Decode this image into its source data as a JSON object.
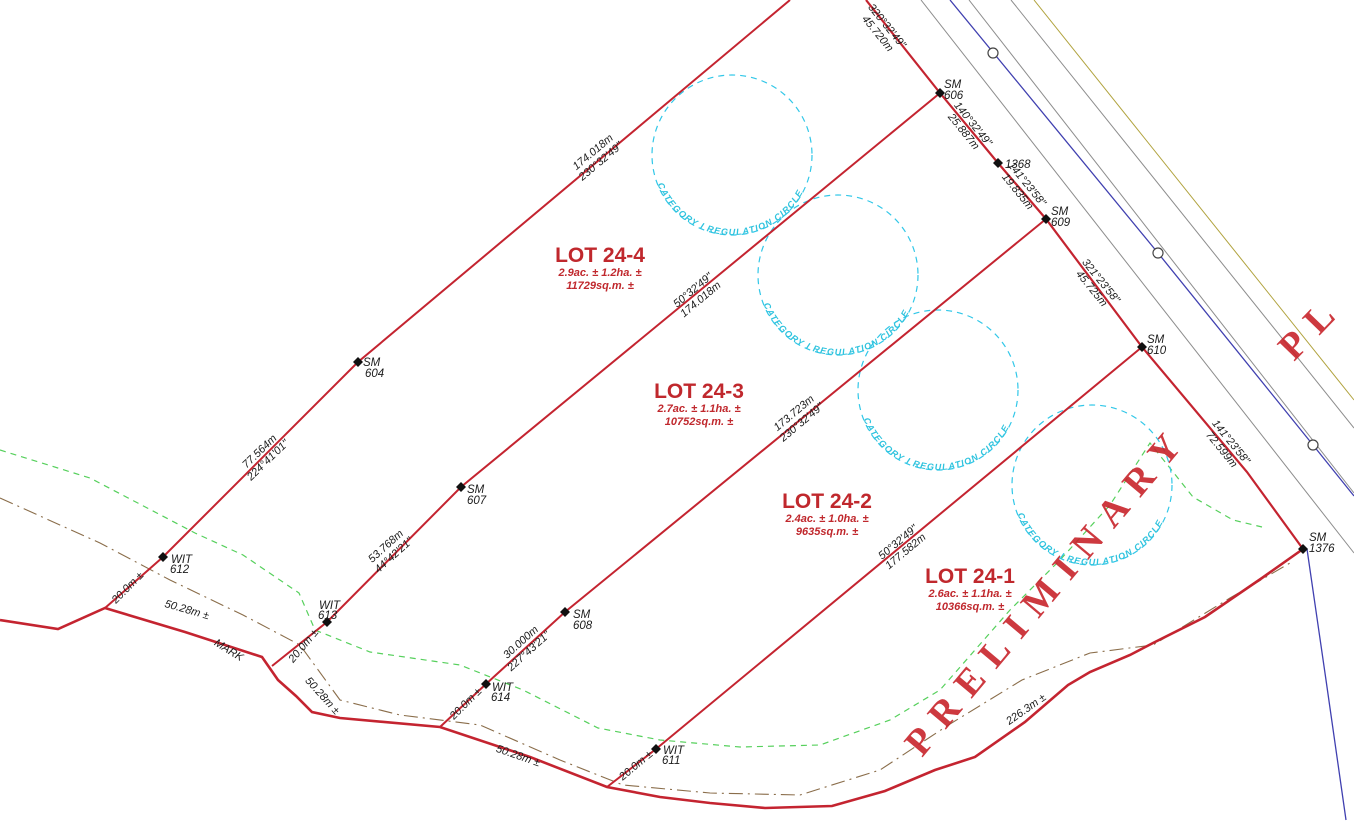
{
  "watermark": {
    "text": "PRELIMINARY",
    "partial": "PL",
    "color": "#c8242b"
  },
  "circle_label": "CATEGORY I REGULATION CIRCLE",
  "lots": [
    {
      "name": "LOT 24-4",
      "area": "2.9ac. ± 1.2ha. ±",
      "sqm": "11729sq.m. ±"
    },
    {
      "name": "LOT 24-3",
      "area": "2.7ac. ± 1.1ha. ±",
      "sqm": "10752sq.m. ±"
    },
    {
      "name": "LOT 24-2",
      "area": "2.4ac. ± 1.0ha. ±",
      "sqm": "9635sq.m. ±"
    },
    {
      "name": "LOT 24-1",
      "area": "2.6ac. ± 1.1ha. ±",
      "sqm": "10366sq.m. ±"
    }
  ],
  "markers": [
    {
      "prefix": "SM",
      "num": "604"
    },
    {
      "prefix": "SM",
      "num": "606"
    },
    {
      "prefix": "",
      "num": "1368"
    },
    {
      "prefix": "SM",
      "num": "609"
    },
    {
      "prefix": "SM",
      "num": "610"
    },
    {
      "prefix": "SM",
      "num": "1376"
    },
    {
      "prefix": "SM",
      "num": "607"
    },
    {
      "prefix": "SM",
      "num": "608"
    },
    {
      "prefix": "WIT",
      "num": "612"
    },
    {
      "prefix": "WIT",
      "num": "613"
    },
    {
      "prefix": "WIT",
      "num": "614"
    },
    {
      "prefix": "WIT",
      "num": "611"
    }
  ],
  "dims": [
    {
      "a": "174.018m",
      "b": "230°32'49\""
    },
    {
      "a": "77.564m",
      "b": "224°41'01\""
    },
    {
      "a": "50°32'49\"",
      "b": "174.018m"
    },
    {
      "a": "53.768m",
      "b": "44°42'21\""
    },
    {
      "a": "173.723m",
      "b": "230°32'49\""
    },
    {
      "a": "30.000m",
      "b": "227°43'21\""
    },
    {
      "a": "50°32'49\"",
      "b": "177.582m"
    },
    {
      "a": "320°32'49\"",
      "b": "45.720m"
    },
    {
      "a": "140°32'49\"",
      "b": "25.887m"
    },
    {
      "a": "141°23'58\"",
      "b": "19.835m"
    },
    {
      "a": "321°23'58\"",
      "b": "45.725m"
    },
    {
      "a": "141°23'58\"",
      "b": "72.599m"
    }
  ],
  "labels": [
    {
      "text": "20.0m ±"
    },
    {
      "text": "20.0m ±"
    },
    {
      "text": "20.0m ±"
    },
    {
      "text": "20.0m ±"
    },
    {
      "text": "50.28m ±"
    },
    {
      "text": "50.28m ±"
    },
    {
      "text": "50.28m ±"
    },
    {
      "text": "226.3m ±"
    },
    {
      "text": "MARK"
    }
  ],
  "colors": {
    "boundary_red": "#c42430",
    "lot_text_red": "#c0282d",
    "regulation_cyan": "#31c7e8",
    "vegetation_green": "#56d05c",
    "watercourse_brown": "#8a6d4a",
    "utility_blue": "#4040b0",
    "road_gray": "#8c8c8c",
    "corner_olive": "#b0a23c",
    "dimension_text": "#1c1c1c",
    "marker_black": "#111111"
  }
}
